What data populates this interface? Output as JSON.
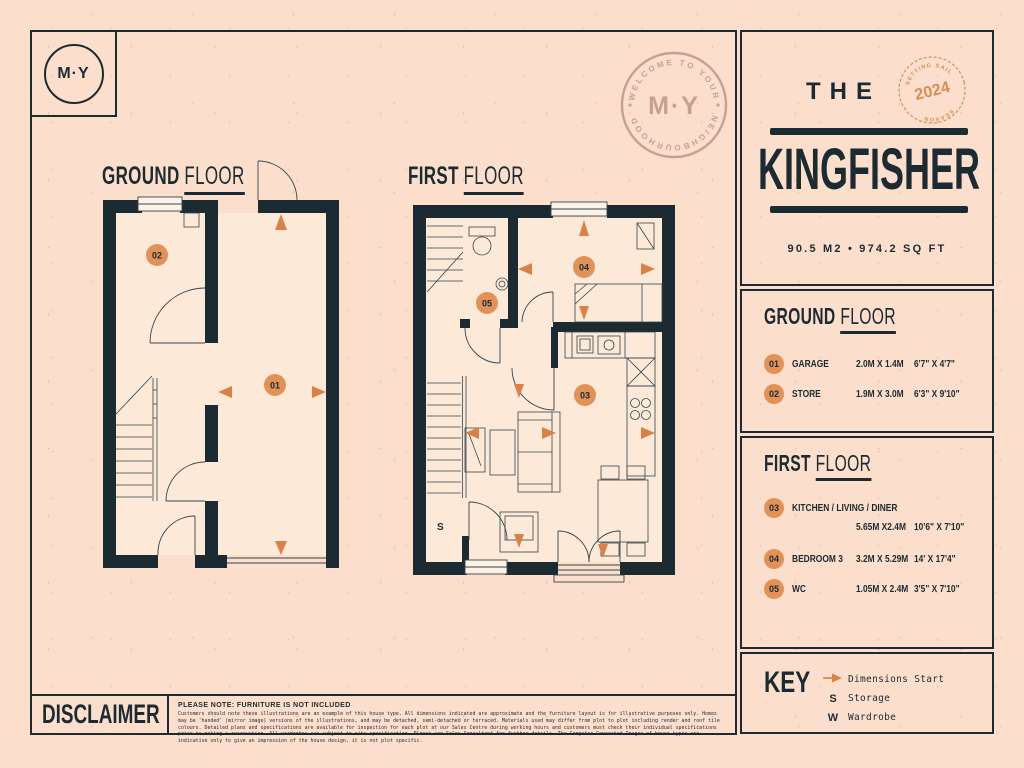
{
  "logo": {
    "text": "M·Y"
  },
  "welcome_badge": {
    "arc_top": "WELCOME TO YOUR",
    "arc_bottom": "NEIGHBOURHOOD",
    "center": "M·Y"
  },
  "title_panel": {
    "eyebrow": "THE",
    "name": "KINGFISHER",
    "stamp": {
      "arc_top": "SETTING SAIL",
      "arc_bottom": "SEASON",
      "year": "2024"
    },
    "area": "90.5 M2 • 974.2 SQ FT"
  },
  "plan_labels": {
    "ground_strong": "GROUND",
    "ground_light": "FLOOR",
    "first_strong": "FIRST",
    "first_light": "FLOOR"
  },
  "ground_plan": {
    "badge_garage": "01",
    "badge_store": "02"
  },
  "first_plan": {
    "badge_kitchen": "03",
    "badge_bedroom": "04",
    "badge_wc": "05",
    "storage_letter": "S"
  },
  "ground_panel": {
    "heading_strong": "GROUND",
    "heading_light": "FLOOR",
    "rooms": [
      {
        "num": "01",
        "name": "GARAGE",
        "metric": "2.0M X 1.4M",
        "imperial": "6'7\" X 4'7\""
      },
      {
        "num": "02",
        "name": "STORE",
        "metric": "1.9M X 3.0M",
        "imperial": "6'3\" X 9'10\""
      }
    ]
  },
  "first_panel": {
    "heading_strong": "FIRST",
    "heading_light": "FLOOR",
    "rooms": [
      {
        "num": "03",
        "name": "KITCHEN / LIVING / DINER",
        "metric": "5.65M X2.4M",
        "imperial": "10'6\" X 7'10\""
      },
      {
        "num": "04",
        "name": "BEDROOM 3",
        "metric": "3.2M X 5.29M",
        "imperial": "14' X 17'4\""
      },
      {
        "num": "05",
        "name": "WC",
        "metric": "1.05M X 2.4M",
        "imperial": "3'5\" X 7'10\""
      }
    ]
  },
  "key_panel": {
    "heading": "KEY",
    "items": [
      {
        "symbol": "",
        "label": "Dimensions Start"
      },
      {
        "symbol": "S",
        "label": "Storage"
      },
      {
        "symbol": "W",
        "label": "Wardrobe"
      }
    ]
  },
  "disclaimer": {
    "heading": "DISCLAIMER",
    "note": "PLEASE NOTE: FURNITURE IS NOT INCLUDED",
    "body": "Customers should note these illustrations are an example of this house type. All dimensions indicated are approximate and the furniture layout is for illustrative purposes only. Homes may be 'handed' (mirror image) versions of the illustrations, and may be detached, semi-detached or terraced. Materials used may differ from plot to plot including render and roof tile colours. Detailed plans and specifications are available for inspection for each plot at our Sales Centre during working hours and customers must check their individual specifications prior to making a reservation. All wardrobes are subject to site specification. Please see Sales Consultant for further details. The Computer Generated Images of house types are indicative only to give an impression of the house design, it is not plot specific."
  }
}
